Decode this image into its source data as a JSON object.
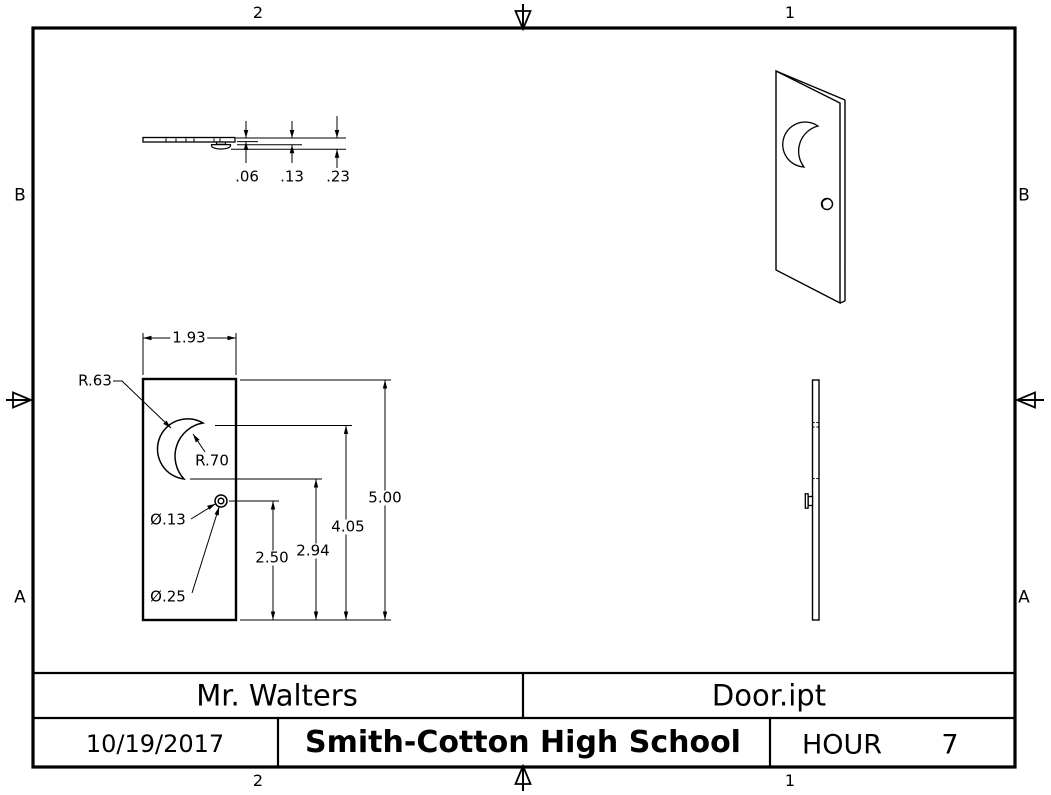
{
  "drawing": {
    "zones": {
      "column_left": "2",
      "column_right": "1",
      "row_upper": "B",
      "row_lower": "A"
    },
    "top_view": {
      "dim_thickness": ".06",
      "dim_knob_base": ".13",
      "dim_knob_tip": ".23"
    },
    "front_view": {
      "dim_width": "1.93",
      "dim_moon_outer_radius": "R.63",
      "dim_moon_inner_radius": "R.70",
      "dim_hole_diameter": "Ø.13",
      "dim_knob_diameter": "Ø.25",
      "dim_knob_center_height": "2.50",
      "dim_moon_bottom_height": "2.94",
      "dim_moon_top_height": "4.05",
      "dim_total_height": "5.00"
    },
    "title_block": {
      "teacher": "Mr. Walters",
      "file_name": "Door.ipt",
      "date": "10/19/2017",
      "school": "Smith-Cotton High School",
      "hour_label": "HOUR",
      "hour_value": "7"
    },
    "colors": {
      "line": "#000000",
      "background": "#ffffff"
    }
  }
}
